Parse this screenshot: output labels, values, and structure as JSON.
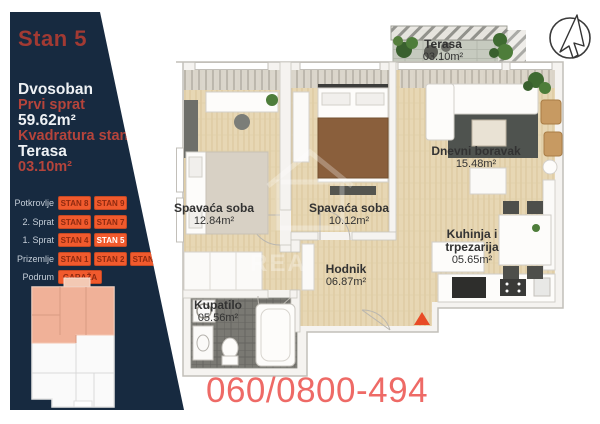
{
  "sidebar": {
    "title": "Stan 5",
    "info": {
      "type": "Dvosoban",
      "floor": "Prvi sprat",
      "area": "59.62m²",
      "area_label": "Kvadratura stana",
      "terrace_label": "Terasa",
      "terrace_area": "03.10m²"
    },
    "floors": [
      {
        "label": "Potkrovlje",
        "units": [
          {
            "label": "STAN 8"
          },
          {
            "label": "STAN 9"
          }
        ]
      },
      {
        "label": "2. Sprat",
        "units": [
          {
            "label": "STAN 6"
          },
          {
            "label": "STAN 7"
          }
        ]
      },
      {
        "label": "1. Sprat",
        "units": [
          {
            "label": "STAN 4"
          },
          {
            "label": "STAN 5",
            "active": true
          }
        ]
      },
      {
        "label": "Prizemlje",
        "units": [
          {
            "label": "STAN 1"
          },
          {
            "label": "STAN 2"
          },
          {
            "label": "STAN 3"
          }
        ]
      },
      {
        "label": "Podrum",
        "units": [
          {
            "label": "GARAŽA",
            "wide": true
          }
        ]
      }
    ],
    "colors": {
      "background": "#172a40",
      "title_red": "#a23a33",
      "accent_red": "#b5443b",
      "button_orange": "#f15a2d",
      "button_text": "#8f2a10",
      "active_unit_text": "#ffffff"
    }
  },
  "floorplan": {
    "rooms": [
      {
        "name": "Terasa",
        "area": "03.10m²"
      },
      {
        "name": "Spavaća soba",
        "area": "12.84m²"
      },
      {
        "name": "Spavaća soba",
        "area": "10.12m²"
      },
      {
        "name": "Dnevni boravak",
        "area": "15.48m²"
      },
      {
        "name": "Kuhinja i trpezarija",
        "area": "05.65m²"
      },
      {
        "name": "Hodnik",
        "area": "06.87m²"
      },
      {
        "name": "Kupatilo",
        "area": "05.56m²"
      }
    ],
    "entrance_marker_color": "#e84b26",
    "watermark_fragment": "REA"
  },
  "footer": {
    "phone": "060/0800-494",
    "phone_color": "#ee6a66"
  }
}
